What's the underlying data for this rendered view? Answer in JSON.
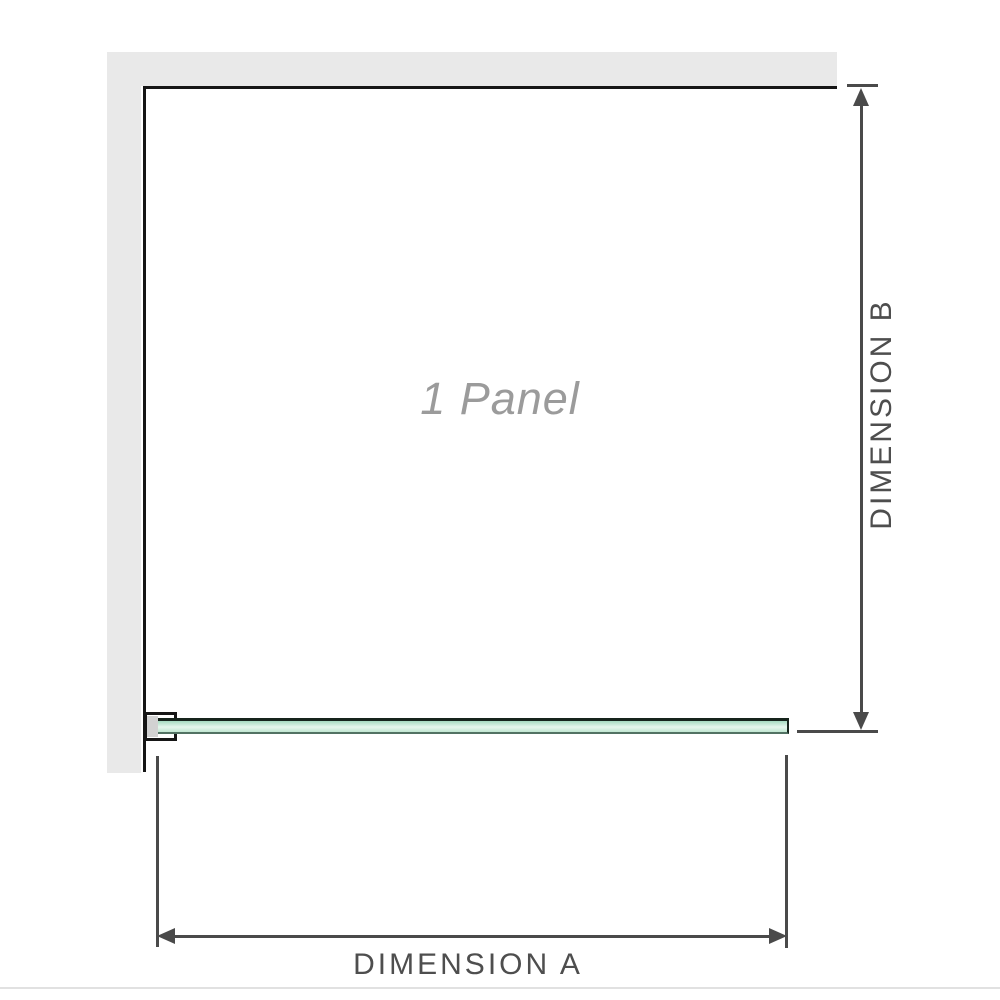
{
  "diagram": {
    "panel_label": "1 Panel",
    "panel_count": 1,
    "dimension_a_label": "DIMENSION A",
    "dimension_b_label": "DIMENSION B",
    "colors": {
      "wall_fill": "#e9e9e9",
      "panel_outline": "#161616",
      "glass_edge": "#16241c",
      "glass_fill_top": "#a5dac0",
      "glass_fill_light": "#e6f6ed",
      "glass_fill_bottom": "#c0e6d1",
      "bracket_pad": "#d2d2d2",
      "dimension_line": "#4a4a4a",
      "dimension_text": "#4e4e4e",
      "watermark_text": "#9b9b9b",
      "separator": "#e1e1e1"
    }
  }
}
